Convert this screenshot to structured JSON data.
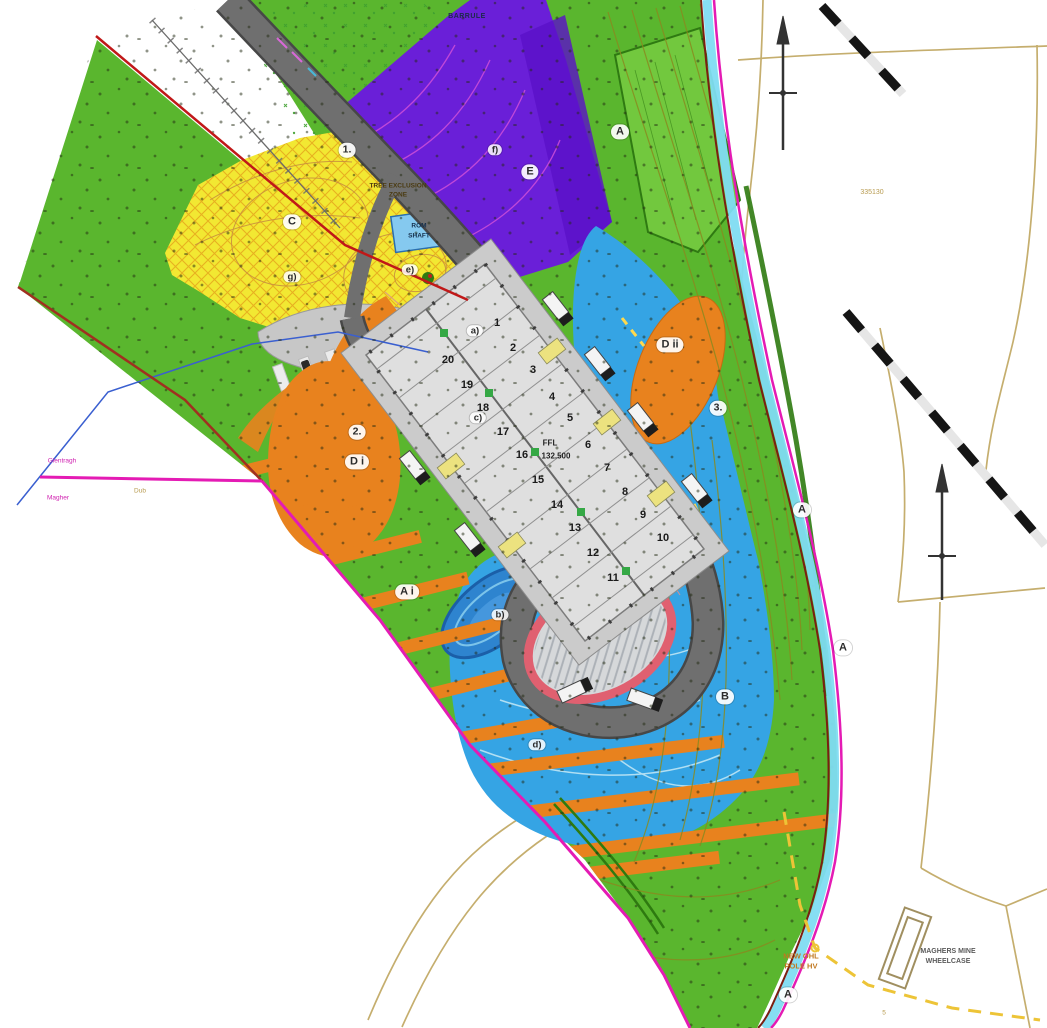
{
  "palette": {
    "green": "#5ab62e",
    "green_dark": "#2f7a12",
    "purple": "#6a1fd8",
    "yellow": "#f2e832",
    "orange": "#e8821e",
    "blue": "#35a4e4",
    "pond": "#2e84cf",
    "cyan": "#7fdcf2",
    "magenta": "#e41bb4",
    "red": "#c01818",
    "road": "#6f6f6f",
    "building": "#dfdfdf",
    "ring": "#e06070",
    "tan": "#c5ae6e",
    "olive": "#8a8a20"
  },
  "zone_labels": [
    {
      "label": "A",
      "x": 620,
      "y": 132
    },
    {
      "label": "A",
      "x": 802,
      "y": 510
    },
    {
      "label": "A",
      "x": 843,
      "y": 648
    },
    {
      "label": "A",
      "x": 788,
      "y": 995
    },
    {
      "label": "A i",
      "x": 407,
      "y": 592
    },
    {
      "label": "B",
      "x": 725,
      "y": 697
    },
    {
      "label": "C",
      "x": 292,
      "y": 222
    },
    {
      "label": "D i",
      "x": 357,
      "y": 462
    },
    {
      "label": "D ii",
      "x": 670,
      "y": 345
    },
    {
      "label": "E",
      "x": 530,
      "y": 172
    }
  ],
  "ref_markers": [
    {
      "label": "1.",
      "x": 347,
      "y": 150
    },
    {
      "label": "2.",
      "x": 357,
      "y": 432
    },
    {
      "label": "3.",
      "x": 718,
      "y": 408
    }
  ],
  "sub_markers": [
    {
      "label": "a)",
      "x": 475,
      "y": 331
    },
    {
      "label": "b)",
      "x": 500,
      "y": 615
    },
    {
      "label": "c)",
      "x": 478,
      "y": 418
    },
    {
      "label": "d)",
      "x": 537,
      "y": 745
    },
    {
      "label": "e)",
      "x": 410,
      "y": 270
    },
    {
      "label": "f)",
      "x": 495,
      "y": 150
    },
    {
      "label": "g)",
      "x": 292,
      "y": 277
    }
  ],
  "bays": [
    {
      "label": "1",
      "x": 497,
      "y": 323
    },
    {
      "label": "2",
      "x": 513,
      "y": 348
    },
    {
      "label": "3",
      "x": 533,
      "y": 370
    },
    {
      "label": "4",
      "x": 552,
      "y": 397
    },
    {
      "label": "5",
      "x": 570,
      "y": 418
    },
    {
      "label": "6",
      "x": 588,
      "y": 445
    },
    {
      "label": "7",
      "x": 607,
      "y": 468
    },
    {
      "label": "8",
      "x": 625,
      "y": 492
    },
    {
      "label": "9",
      "x": 643,
      "y": 515
    },
    {
      "label": "10",
      "x": 663,
      "y": 538
    },
    {
      "label": "11",
      "x": 613,
      "y": 578
    },
    {
      "label": "12",
      "x": 593,
      "y": 553
    },
    {
      "label": "13",
      "x": 575,
      "y": 528
    },
    {
      "label": "14",
      "x": 557,
      "y": 505
    },
    {
      "label": "15",
      "x": 538,
      "y": 480
    },
    {
      "label": "16",
      "x": 522,
      "y": 455
    },
    {
      "label": "17",
      "x": 503,
      "y": 432
    },
    {
      "label": "18",
      "x": 483,
      "y": 408
    },
    {
      "label": "19",
      "x": 467,
      "y": 385
    },
    {
      "label": "20",
      "x": 448,
      "y": 360
    }
  ],
  "texts": {
    "barrule": "BARRULE",
    "tree_exclusion_line1": "TREE EXCLUSION",
    "tree_exclusion_line2": "ZONE",
    "rom_line1": "ROM",
    "rom_line2": "SHAFT",
    "ffl_line1": "FFL",
    "ffl_line2": "132.500",
    "ohl_line1": "NEW OHL",
    "ohl_line2": "POLE HV",
    "wheelcase_line1": "MAGHERS MINE",
    "wheelcase_line2": "WHEELCASE",
    "grid_ref": "335130",
    "small_place_1": "Glentragh",
    "small_place_2": "Magher",
    "small_track": "Dub",
    "small_num": "5"
  }
}
